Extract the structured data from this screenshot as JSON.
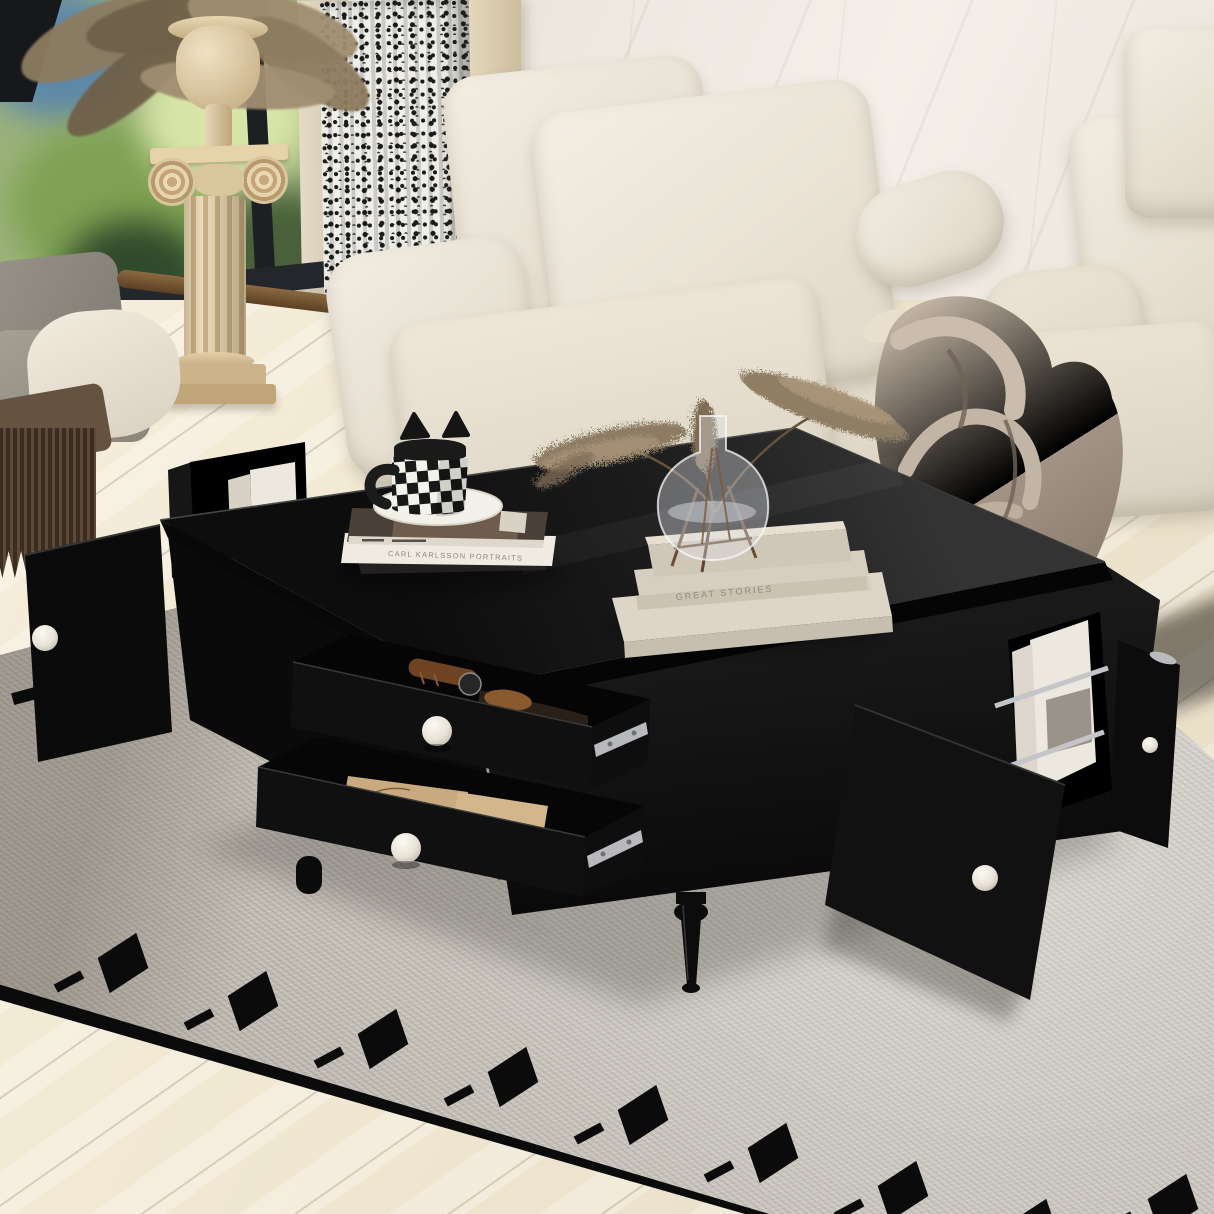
{
  "texts": {
    "white_book_spine": "CARL KARLSSON PORTRAITS",
    "decor_book_spine": "GREAT STORIES"
  },
  "colors": {
    "table_black": "#121212",
    "table_hi": "#2e2e2e",
    "knob": "#f1ede3",
    "rug": "#d8d3ca",
    "rug_black": "#0b0b0b",
    "floor": "#f0e7d2",
    "wall": "#f2eee7",
    "sofa": "#efe9dd",
    "blanket": "#a89a8c",
    "curtain": "#efeee8",
    "curtain_ink": "#1b1b1b",
    "pedestal": "#e6d6b4",
    "chrome": "#c3c5c9",
    "kraft": "#c8a87c",
    "leather": "#7b4a26",
    "pampas": "#8c7b64",
    "glass": "#e2e6e9"
  },
  "rug": {
    "squares": [
      [
        100,
        945
      ],
      [
        230,
        983
      ],
      [
        360,
        1021
      ],
      [
        490,
        1059
      ],
      [
        620,
        1097
      ],
      [
        750,
        1135
      ],
      [
        880,
        1173
      ],
      [
        1010,
        1211
      ],
      [
        1150,
        1186
      ]
    ],
    "dashes": [
      [
        12,
        688,
        40,
        12
      ],
      [
        66,
        697,
        24,
        10
      ]
    ]
  }
}
